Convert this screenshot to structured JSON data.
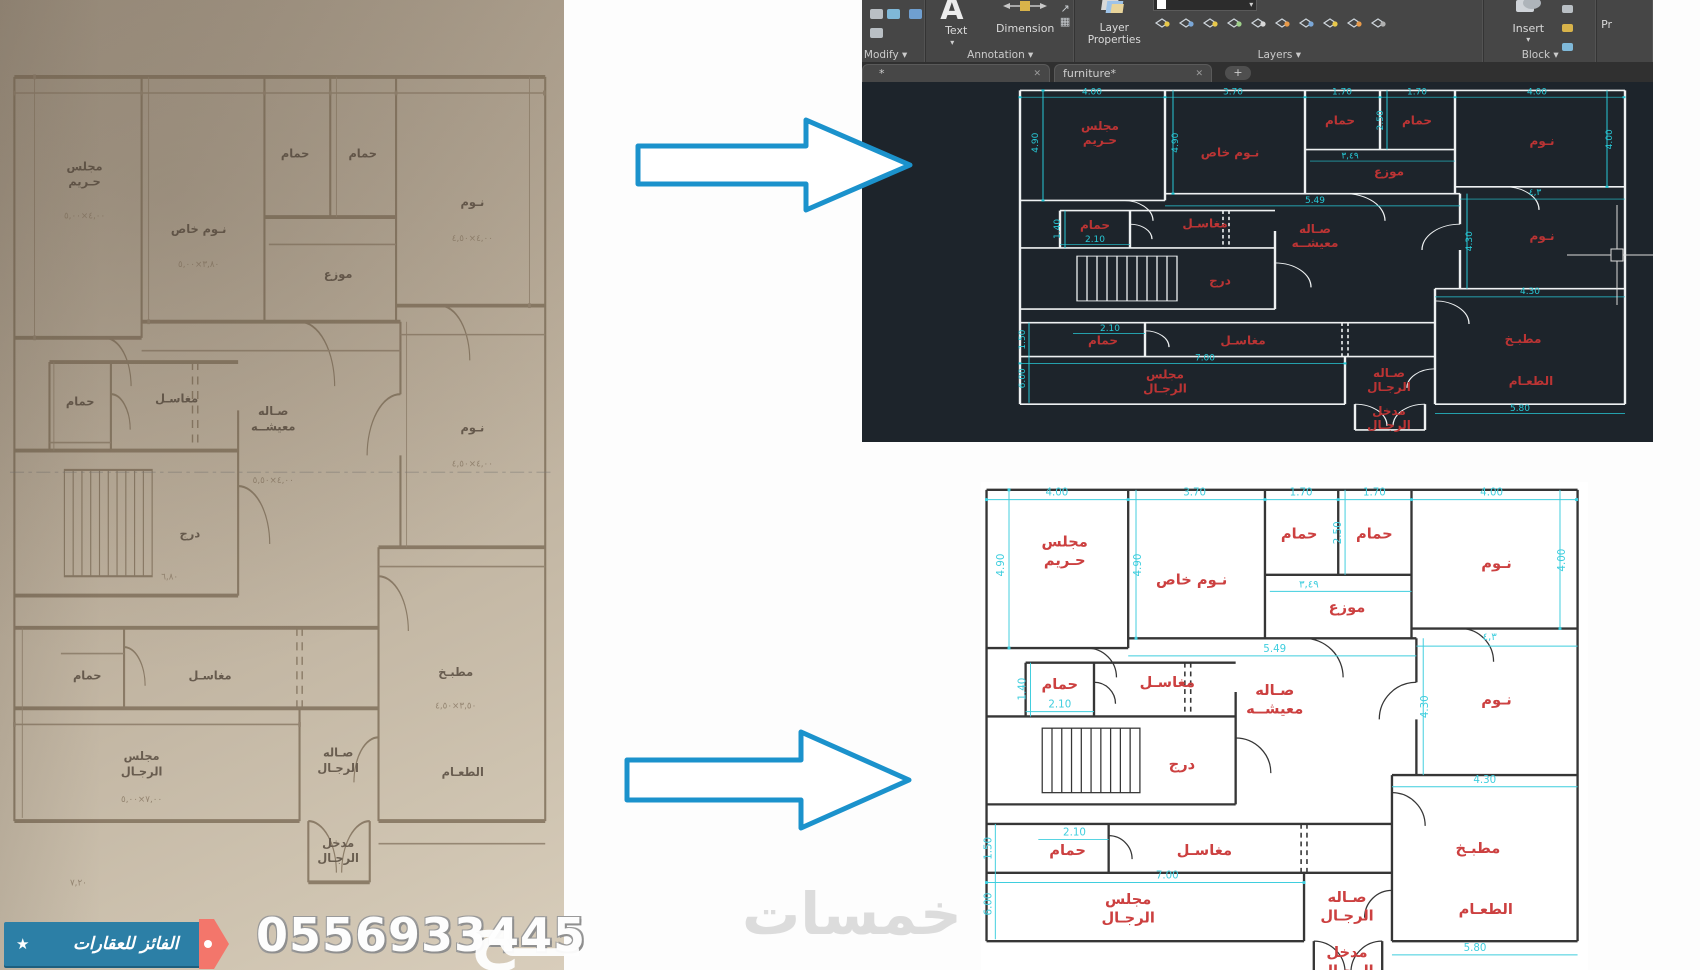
{
  "banner": {
    "star": "★",
    "company": "الفائز للعقارات",
    "phone": "0556933445",
    "colors": {
      "ribbon": "#2c7fa6",
      "accent": "#f3766b"
    }
  },
  "watermarks": {
    "center": "خمسات",
    "side": "ـــح"
  },
  "icons": {
    "caret": "▾",
    "close": "✕"
  },
  "acad": {
    "tabs": [
      {
        "label": "*"
      },
      {
        "label": "furniture*"
      }
    ],
    "new_tab_label": "+",
    "ribbon": {
      "modify": {
        "label": "Modify ▾"
      },
      "annotation": {
        "label": "Annotation ▾",
        "text_btn": "Text",
        "dimension_btn": "Dimension",
        "table_icon": "▦"
      },
      "layers": {
        "label": "Layers ▾",
        "layer_properties_btn": "Layer Properties"
      },
      "block": {
        "label": "Block ▾",
        "insert_btn": "Insert"
      },
      "properties": {
        "label_partial": "Pr"
      }
    },
    "colors": {
      "canvas_bg": "#1d242b",
      "wall": "#eef1f2",
      "dim": "#27c9d7",
      "label": "#bb3434"
    }
  },
  "plan": {
    "colors": {
      "light_wall": "#363636",
      "light_dim": "#3fcede",
      "light_label": "#cc4040"
    },
    "rooms": [
      {
        "lines": [
          "مجلس",
          "حـريم"
        ],
        "x": 85,
        "y": 66
      },
      {
        "lines": [
          "نـوم خاص"
        ],
        "x": 215,
        "y": 105
      },
      {
        "lines": [
          "حمام"
        ],
        "x": 325,
        "y": 58
      },
      {
        "lines": [
          "حمام"
        ],
        "x": 402,
        "y": 58
      },
      {
        "lines": [
          "نـوم"
        ],
        "x": 527,
        "y": 88
      },
      {
        "lines": [
          "موزع"
        ],
        "x": 374,
        "y": 133
      },
      {
        "lines": [
          "نـوم"
        ],
        "x": 527,
        "y": 228
      },
      {
        "lines": [
          "حمام"
        ],
        "x": 80,
        "y": 212
      },
      {
        "lines": [
          "مغاسـل"
        ],
        "x": 190,
        "y": 210
      },
      {
        "lines": [
          "صـاله",
          "معيشــه"
        ],
        "x": 300,
        "y": 218
      },
      {
        "lines": [
          "درج"
        ],
        "x": 205,
        "y": 294
      },
      {
        "lines": [
          "حمام"
        ],
        "x": 88,
        "y": 382
      },
      {
        "lines": [
          "مغاسـل"
        ],
        "x": 228,
        "y": 382
      },
      {
        "lines": [
          "مطبـخ"
        ],
        "x": 508,
        "y": 380
      },
      {
        "lines": [
          "مجلس",
          "الرجـال"
        ],
        "x": 150,
        "y": 432
      },
      {
        "lines": [
          "صـاله",
          "الرجـال"
        ],
        "x": 374,
        "y": 430
      },
      {
        "lines": [
          "مدخل",
          "الرجـال"
        ],
        "x": 374,
        "y": 486
      },
      {
        "lines": [
          "الطعـام"
        ],
        "x": 516,
        "y": 442
      }
    ],
    "dims": [
      {
        "t": "4.00",
        "x": 77,
        "y": 14
      },
      {
        "t": "3.70",
        "x": 218,
        "y": 14
      },
      {
        "t": "1.70",
        "x": 327,
        "y": 14
      },
      {
        "t": "1.70",
        "x": 402,
        "y": 14
      },
      {
        "t": "4.00",
        "x": 522,
        "y": 14
      },
      {
        "t": "4.90",
        "x": 23,
        "y": 85,
        "r": 1
      },
      {
        "t": "4.90",
        "x": 163,
        "y": 85,
        "r": 1
      },
      {
        "t": "2.50",
        "x": 368,
        "y": 52,
        "r": 1
      },
      {
        "t": "4.00",
        "x": 597,
        "y": 80,
        "r": 1
      },
      {
        "t": "٣,٤٩",
        "x": 335,
        "y": 108
      },
      {
        "t": "5.49",
        "x": 300,
        "y": 174
      },
      {
        "t": "٤,٣",
        "x": 520,
        "y": 162
      },
      {
        "t": "4.30",
        "x": 457,
        "y": 230,
        "r": 1
      },
      {
        "t": "1.40",
        "x": 45,
        "y": 212,
        "r": 1
      },
      {
        "t": "2.10",
        "x": 80,
        "y": 231
      },
      {
        "t": "2.10",
        "x": 95,
        "y": 362
      },
      {
        "t": "1.50",
        "x": 10,
        "y": 375,
        "r": 1
      },
      {
        "t": "7.00",
        "x": 190,
        "y": 406
      },
      {
        "t": "4.30",
        "x": 515,
        "y": 308
      },
      {
        "t": "6.00",
        "x": 10,
        "y": 432,
        "r": 1
      },
      {
        "t": "5.80",
        "x": 505,
        "y": 480
      }
    ]
  },
  "photo": {
    "dims": [
      {
        "t": "٤,٠٠×٥,٠٠",
        "x": 85,
        "y": 96
      },
      {
        "t": "٣,٨٠×٥,٠٠",
        "x": 215,
        "y": 126
      },
      {
        "t": "٤,٠٠×٤,٥٠",
        "x": 527,
        "y": 110
      },
      {
        "t": "٤,٠٠×٤,٥٠",
        "x": 527,
        "y": 250
      },
      {
        "t": "٤,٠٠×٥,٥٠",
        "x": 300,
        "y": 260
      },
      {
        "t": "٦,٨٠",
        "x": 182,
        "y": 320
      },
      {
        "t": "٣,٥٠×٤,٥٠",
        "x": 508,
        "y": 400
      },
      {
        "t": "٧,٠٠×٥,٠٠",
        "x": 150,
        "y": 458
      },
      {
        "t": "٧,٢٠",
        "x": 78,
        "y": 510
      }
    ]
  }
}
